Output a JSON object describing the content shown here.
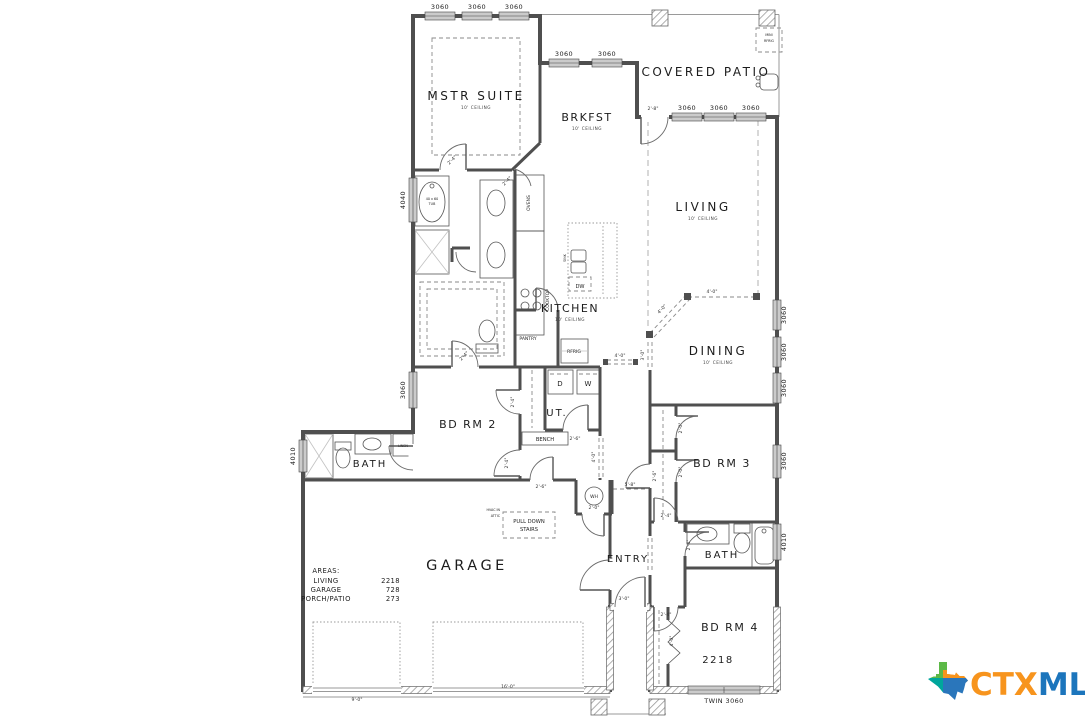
{
  "plan": {
    "rooms": {
      "mstr": {
        "name": "MSTR SUITE",
        "sub": "10' CEILING"
      },
      "brkfst": {
        "name": "BRKFST",
        "sub": "10' CEILING"
      },
      "patio": {
        "name": "COVERED PATIO"
      },
      "living": {
        "name": "LIVING",
        "sub": "10' CEILING"
      },
      "kitchen": {
        "name": "KITCHEN",
        "sub": "10' CEILING"
      },
      "dining": {
        "name": "DINING",
        "sub": "10' CEILING"
      },
      "bdrm2": {
        "name": "BD RM 2"
      },
      "bath2": {
        "name": "BATH"
      },
      "ut": {
        "name": "UT."
      },
      "bdrm3": {
        "name": "BD RM 3"
      },
      "entry": {
        "name": "ENTRY"
      },
      "bath3": {
        "name": "BATH"
      },
      "bdrm4": {
        "name": "BD RM 4"
      },
      "garage": {
        "name": "GARAGE"
      },
      "plan_number": "2218"
    },
    "fixtures": {
      "tub_l1": "40 x 60",
      "tub_l2": "TUB",
      "mini_frig_l1": "MINI",
      "mini_frig_l2": "RFRIG",
      "ovens": "OVENS",
      "cooktop": "COOKTOP",
      "pantry": "PANTRY",
      "rfrig": "RFRIG",
      "sink": "SINK",
      "dw": "DW",
      "dryer": "D",
      "washer": "W",
      "bench": "BENCH",
      "linen": "LINEN",
      "wh": "WH",
      "stairs_l1": "PULL DOWN",
      "stairs_l2": "STAIRS",
      "hvac_l1": "HVAC IN",
      "hvac_l2": "ATTIC"
    },
    "windows": {
      "w3060": "3060",
      "w4040": "4040",
      "w4010": "4010",
      "twin3060": "TWIN 3060"
    },
    "dims": {
      "d2_0": "2'-0\"",
      "d2_4": "2'-4\"",
      "d2_6": "2'-6\"",
      "d2_8": "2'-8\"",
      "d3_0": "3'-0\"",
      "d4_0": "4'-0\"",
      "d5_8": "5'-8\"",
      "d9_0": "9'-0\"",
      "d16_0": "16'-0\""
    },
    "areas": {
      "title": "AREAS:",
      "rows": [
        {
          "name": "LIVING",
          "value": "2218"
        },
        {
          "name": "GARAGE",
          "value": "728"
        },
        {
          "name": "PORCH/PATIO",
          "value": "273"
        }
      ]
    }
  },
  "logo": {
    "ctx": "CTX",
    "mls": "MLS"
  },
  "colors": {
    "wall": "#4f4f4f",
    "window_fill": "#cbcbcb",
    "logo_orange": "#F7941D",
    "logo_blue": "#1C75BC",
    "logo_green": "#5CB947",
    "logo_teal": "#00A69C"
  }
}
